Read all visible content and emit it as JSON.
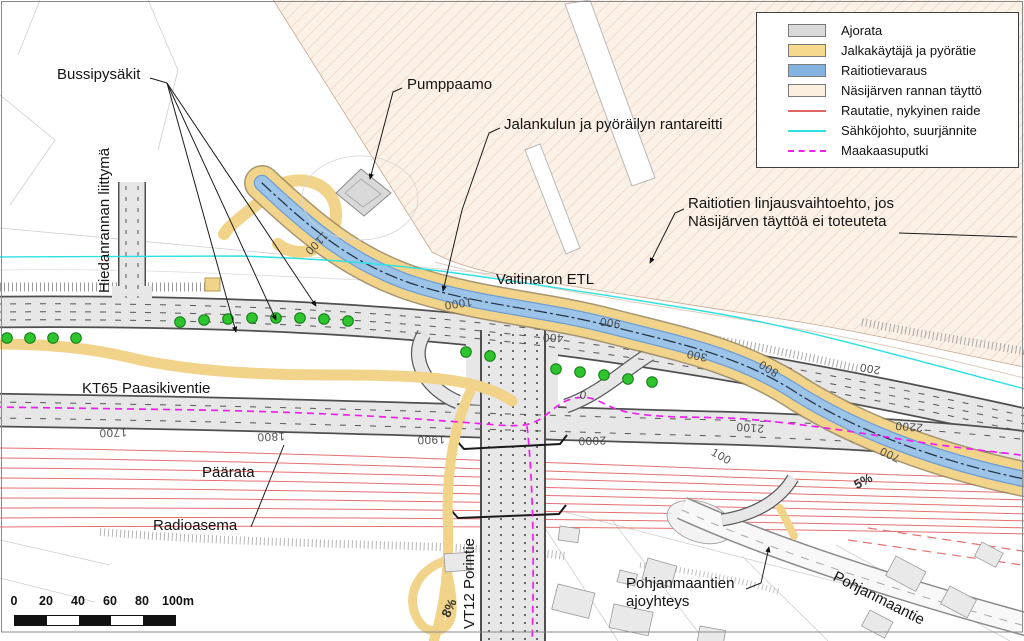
{
  "legend": {
    "items": [
      {
        "name": "ajorata",
        "label": "Ajorata",
        "swatch": "fill",
        "color": "#d9d9d9"
      },
      {
        "name": "jalkakaytava",
        "label": "Jalkakäytäjä ja pyörätie",
        "swatch": "fill",
        "color": "#f6d98d"
      },
      {
        "name": "raitiotievaraus",
        "label": "Raitiotievaraus",
        "swatch": "fill",
        "color": "#85b3e1"
      },
      {
        "name": "nasijarven-taytto",
        "label": "Näsijärven rannan täyttö",
        "swatch": "fill",
        "color": "#fbeedf"
      },
      {
        "name": "rautatie",
        "label": "Rautatie, nykyinen raide",
        "swatch": "line",
        "color": "#e06666"
      },
      {
        "name": "sahkojohto",
        "label": "Sähköjohto, suurjännite",
        "swatch": "line",
        "color": "#2ee1e1"
      },
      {
        "name": "maakaasuputki",
        "label": "Maakaasuputki",
        "swatch": "dashed-line",
        "color": "#f01ef0"
      }
    ]
  },
  "labels": {
    "bussipysakit": "Bussipysäkit",
    "pumppaamo": "Pumppaamo",
    "rantareitti": "Jalankulun ja pyöräilyn rantareitti",
    "raitiotie_line1": "Raitiotien linjausvaihtoehto, jos",
    "raitiotie_line2": "Näsijärven täyttöä ei toteuteta",
    "vaitinaro": "Vaitinaron ETL",
    "hiedanranta": "Hiedanrannan liittymä",
    "kt65": "KT65 Paasikiventie",
    "paarata": "Päärata",
    "radioasema": "Radioasema",
    "vt12": "VT12 Porintie",
    "ajoyhteys_line1": "Pohjanmaantien",
    "ajoyhteys_line2": "ajoyhteys",
    "pohjanmaantie": "Pohjanmaantie"
  },
  "chainage_markers": [
    {
      "text": "1100",
      "x": 316,
      "y": 243,
      "rot": 135
    },
    {
      "text": "1000",
      "x": 458,
      "y": 303,
      "rot": 172
    },
    {
      "text": "900",
      "x": 610,
      "y": 322,
      "rot": 188
    },
    {
      "text": "800",
      "x": 769,
      "y": 368,
      "rot": 212
    },
    {
      "text": "700",
      "x": 890,
      "y": 454,
      "rot": 205
    },
    {
      "text": "400",
      "x": 553,
      "y": 337,
      "rot": 183
    },
    {
      "text": "300",
      "x": 697,
      "y": 355,
      "rot": 192
    },
    {
      "text": "200",
      "x": 870,
      "y": 368,
      "rot": 190
    },
    {
      "text": "100",
      "x": 721,
      "y": 457,
      "rot": 30
    },
    {
      "text": "0",
      "x": 583,
      "y": 396,
      "rot": 15
    },
    {
      "text": "1700",
      "x": 113,
      "y": 432,
      "rot": 178
    },
    {
      "text": "1800",
      "x": 271,
      "y": 436,
      "rot": 178
    },
    {
      "text": "1900",
      "x": 431,
      "y": 439,
      "rot": 178
    },
    {
      "text": "2000",
      "x": 592,
      "y": 440,
      "rot": 178
    },
    {
      "text": "2100",
      "x": 750,
      "y": 427,
      "rot": 184
    },
    {
      "text": "2200",
      "x": 909,
      "y": 426,
      "rot": 184
    }
  ],
  "gradient_markers": [
    {
      "text": "5%",
      "x": 863,
      "y": 481,
      "rot": -28
    },
    {
      "text": "8%",
      "x": 449,
      "y": 608,
      "rot": -65
    }
  ],
  "scale_bar": {
    "ticks": [
      "0",
      "20",
      "40",
      "60",
      "80",
      "100m"
    ]
  }
}
